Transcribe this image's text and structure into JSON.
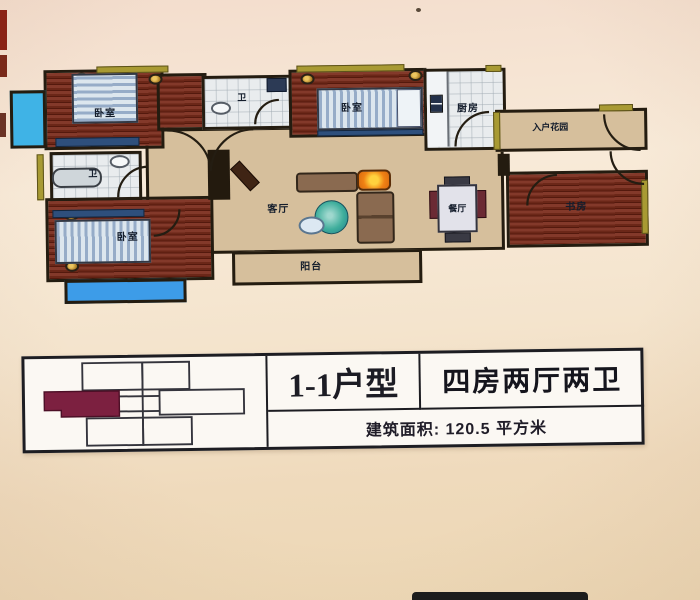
{
  "plan": {
    "rooms": {
      "bedroom_a": {
        "label": "卧室"
      },
      "bath_a": {
        "label": "卫"
      },
      "bedroom_b": {
        "label": "卧室"
      },
      "bath_b": {
        "label": "卫"
      },
      "bedroom_c": {
        "label": "卧室"
      },
      "kitchen": {
        "label": "厨房"
      },
      "entry_garden": {
        "label": "入户花园"
      },
      "living": {
        "label": "客厅"
      },
      "dining": {
        "label": "餐厅"
      },
      "study": {
        "label": "书房"
      },
      "balcony": {
        "label": "阳台"
      }
    },
    "colors": {
      "wood_floor": "#6b2718",
      "hall_floor": "#d6bf9c",
      "tile_floor": "#e9ecee",
      "window_blue": "#3fb3e6",
      "wall_accent_olive": "#a89a33",
      "wall_black": "#241c10",
      "lamp_orange": "#f08214"
    }
  },
  "info_table": {
    "unit_type": "1-1户型",
    "layout": "四房两厅两卫",
    "area_label": "建筑面积: 120.5 平方米",
    "highlight_color": "#7c2040"
  }
}
